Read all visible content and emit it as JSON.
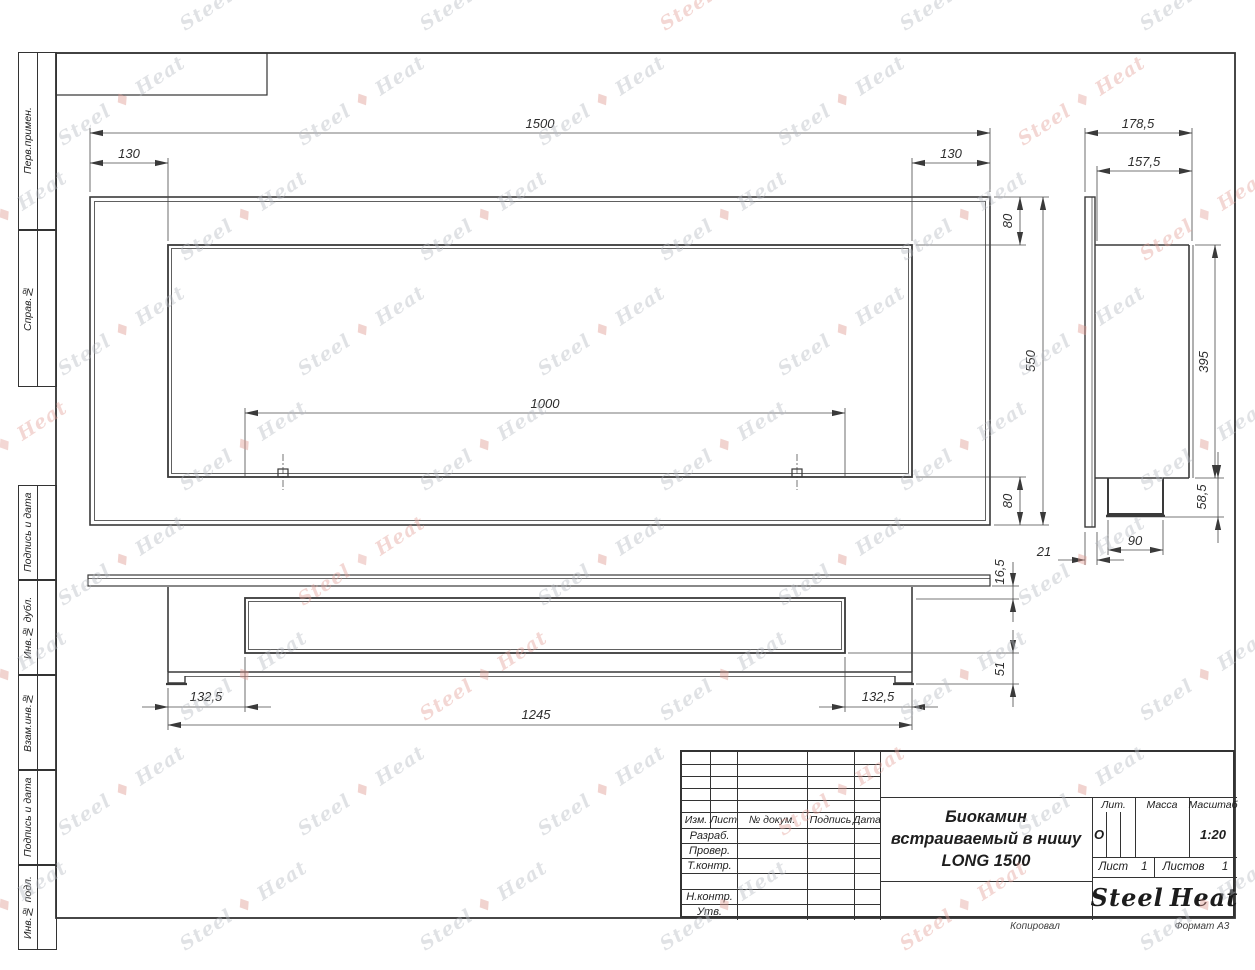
{
  "left_column": {
    "cells": [
      "Перв.примен.",
      "Справ.№",
      "Подпись и дата",
      "Инв.№ дубл.",
      "Взам.инв.№",
      "Подпись и дата",
      "Инв.№ подл."
    ]
  },
  "views": {
    "front": {
      "dims": {
        "total": "1500",
        "left_offset": "130",
        "right_offset": "130",
        "opening": "1000",
        "top": "80",
        "height": "550",
        "bottom": "80"
      }
    },
    "side": {
      "dims": {
        "total_depth": "178,5",
        "body_depth": "157,5",
        "body_height": "395",
        "burner_height": "58,5",
        "burner_width": "90",
        "flange": "21"
      }
    },
    "bottom": {
      "dims": {
        "flange_gap": "16,5",
        "foot_height": "51",
        "left_offset": "132,5",
        "right_offset": "132,5",
        "body_width": "1245"
      }
    }
  },
  "title_block": {
    "header_cols": [
      "Изм.",
      "Лист",
      "№ докум.",
      "Подпись",
      "Дата"
    ],
    "rows": [
      "Разраб.",
      "Провер.",
      "Т.контр.",
      "Н.контр.",
      "Утв."
    ],
    "title_lines": [
      "Биокамин",
      "встраиваемый в нишу",
      "LONG 1500"
    ],
    "lit_label": "Лит.",
    "lit_value": "О",
    "massa_label": "Масса",
    "masshtab_label": "Масштаб",
    "masshtab_value": "1:20",
    "list_label": "Лист",
    "list_value": "1",
    "listov_label": "Листов",
    "listov_value": "1",
    "logo": {
      "part1": "Steel",
      "part2": "Heat",
      "flame_color": "#e8211d"
    },
    "footer_left": "Копировал",
    "footer_right": "Формат А3"
  },
  "watermark": {
    "text_left": "Steel",
    "text_right": "Heat",
    "flame_glyph": "♦",
    "color": "#b7bbc3",
    "accent": "#e4a29a",
    "flame": "#e0978f"
  }
}
